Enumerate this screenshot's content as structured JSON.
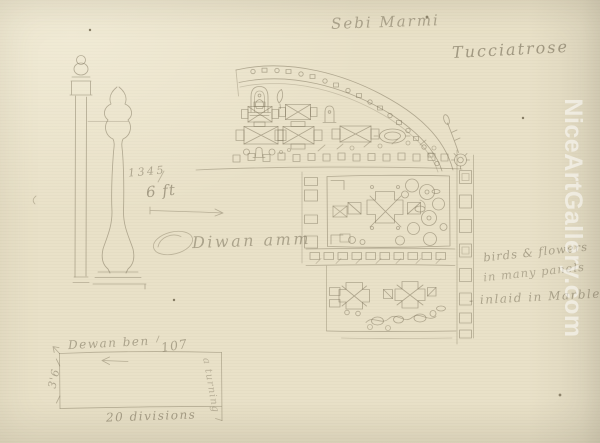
{
  "artwork": {
    "inscriptions": {
      "top_center": "Sebi Marmi",
      "top_right": "Tucciatrose",
      "side_note_line1": "birds & flowers",
      "side_note_line2": "in many panels",
      "side_note_line3": "- inlaid in Marble",
      "center_script": "Diwan amm",
      "figure_number": "1345",
      "height_dim": "6 ft",
      "diagram_label": "Dewan ben",
      "diagram_number": "107",
      "diagram_left_dim": "3'6",
      "diagram_bottom_label": "20 divisions",
      "diagram_right_note": "a turning"
    },
    "watermark": {
      "text": "NiceArtGallery.com",
      "color": "#ffffff"
    },
    "colors": {
      "paper": "#e9e1c8",
      "pencil": "#7a7058",
      "script": "#6f6650"
    }
  }
}
